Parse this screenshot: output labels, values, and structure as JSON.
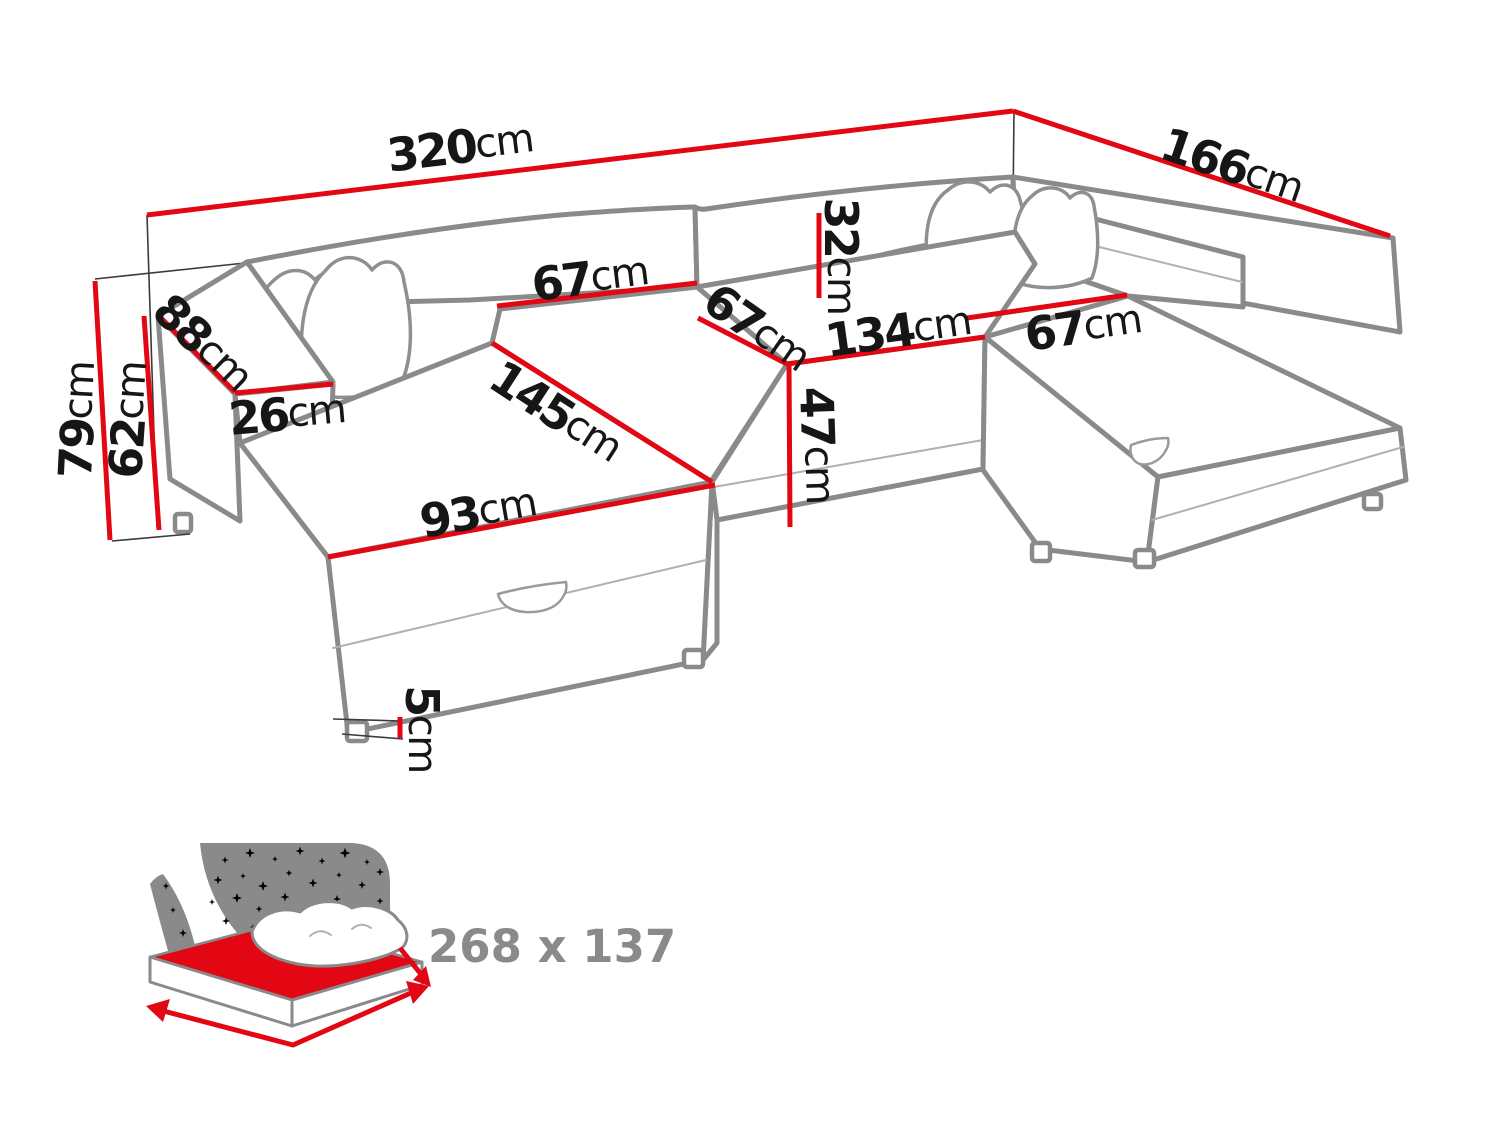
{
  "colors": {
    "dimension_line_red": "#e30613",
    "sofa_outline_gray": "#8a8a8a",
    "label_black": "#161616",
    "icon_gray": "#8a8a8a"
  },
  "dimensions": {
    "total_width": {
      "value": "320",
      "unit": "cm"
    },
    "total_depth": {
      "value": "166",
      "unit": "cm"
    },
    "total_height": {
      "value": "79",
      "unit": "cm"
    },
    "armrest_height": {
      "value": "62",
      "unit": "cm"
    },
    "armrest_length": {
      "value": "88",
      "unit": "cm"
    },
    "armrest_width": {
      "value": "26",
      "unit": "cm"
    },
    "backrest_seat_width": {
      "value": "67",
      "unit": "cm"
    },
    "middle_seat_width": {
      "value": "67",
      "unit": "cm"
    },
    "corner_section_width": {
      "value": "134",
      "unit": "cm"
    },
    "right_seat_width": {
      "value": "67",
      "unit": "cm"
    },
    "backrest_height": {
      "value": "32",
      "unit": "cm"
    },
    "seat_height": {
      "value": "47",
      "unit": "cm"
    },
    "chaise_length": {
      "value": "145",
      "unit": "cm"
    },
    "chaise_front_width": {
      "value": "93",
      "unit": "cm"
    },
    "leg_height": {
      "value": "5",
      "unit": "cm"
    }
  },
  "sleeping_area": {
    "icon": "sleeping-function-icon",
    "label": "268 x 137"
  }
}
